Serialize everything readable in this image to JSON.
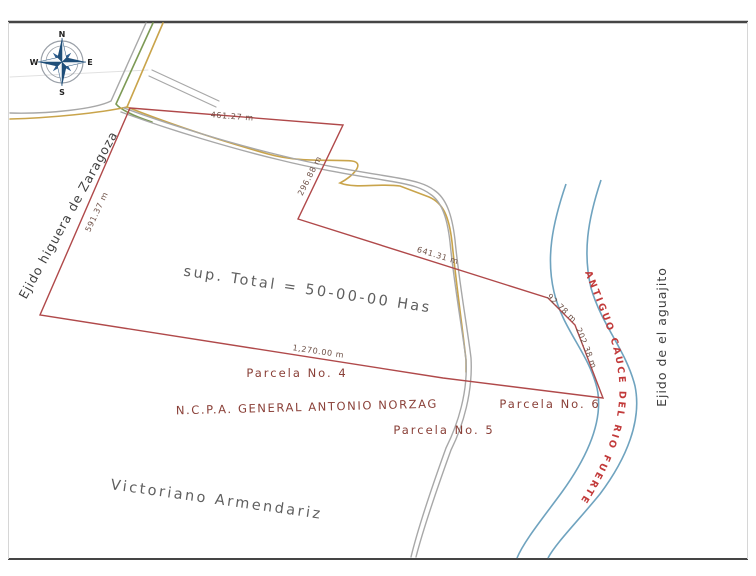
{
  "compass": {
    "north": "N",
    "south": "S",
    "east": "E",
    "west": "W"
  },
  "boundaries": {
    "left": "Ejido higuera de Zaragoza",
    "right": "Ejido de el aguajito",
    "bottom": "Victoriano Armendariz",
    "river": "ANTIGUO CAUCE DEL RIO FUERTE"
  },
  "area": {
    "total": "sup. Total = 50-00-00 Has"
  },
  "owner": {
    "name": "N.C.P.A. GENERAL ANTONIO NORZAG"
  },
  "parcels": [
    {
      "label": "Parcela No. 4"
    },
    {
      "label": "Parcela No. 5"
    },
    {
      "label": "Parcela No. 6"
    }
  ],
  "dimensions": [
    {
      "label": "461.27 m"
    },
    {
      "label": "296.88 m"
    },
    {
      "label": "591.37 m"
    },
    {
      "label": "641.31 m"
    },
    {
      "label": "1,270.00 m"
    },
    {
      "label": "92.78 m"
    },
    {
      "label": "202.38 m"
    }
  ],
  "colors": {
    "boundary": "#b0494a",
    "river": "#6fa3bf",
    "river_label": "#c23a3a",
    "road_gray": "#a8a8a8",
    "road_tan": "#c9a44b",
    "road_green": "#7d9a55",
    "frame": "#4a4a4a"
  }
}
